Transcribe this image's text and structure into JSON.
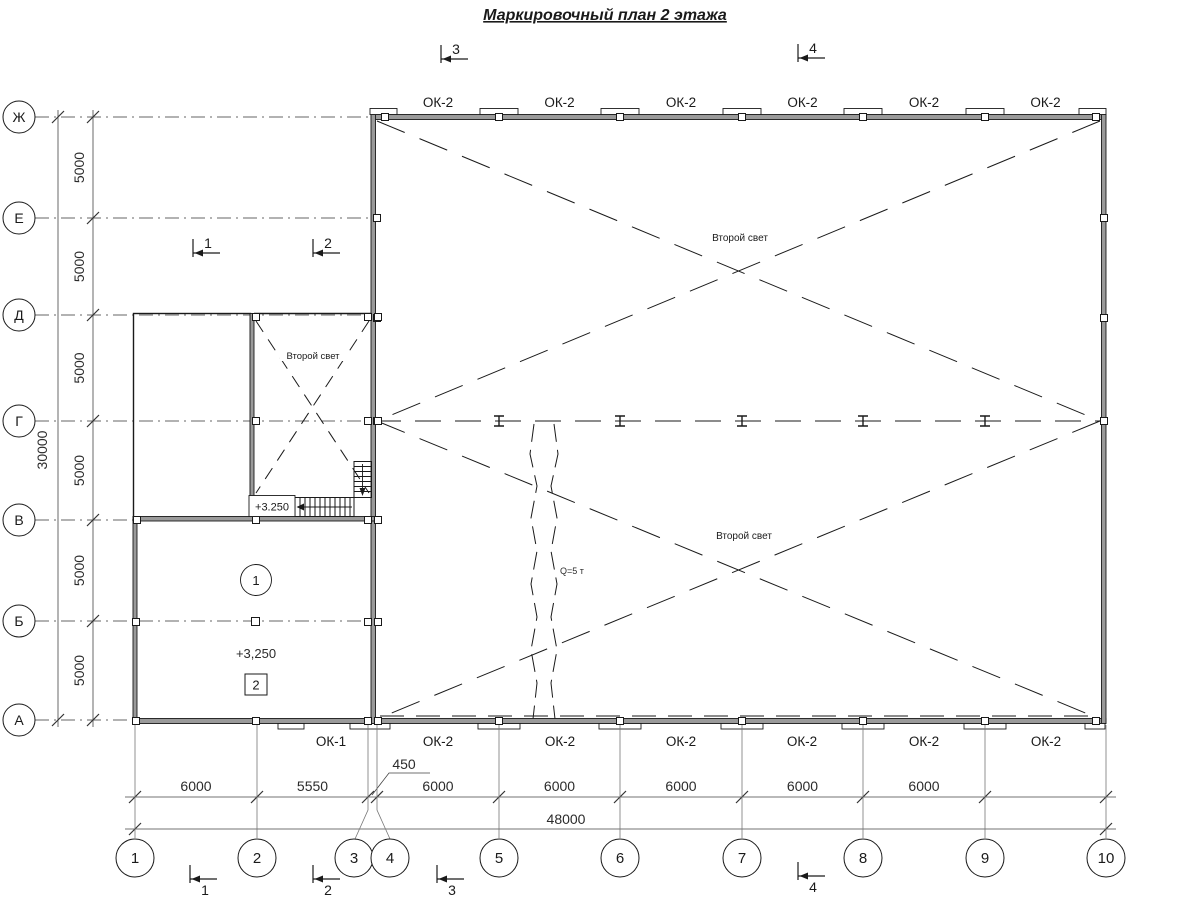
{
  "title": "Маркировочный план 2 этажа",
  "grid": {
    "row_axes": [
      "Ж",
      "Е",
      "Д",
      "Г",
      "В",
      "Б",
      "А"
    ],
    "col_axes": [
      "1",
      "2",
      "3",
      "4",
      "5",
      "6",
      "7",
      "8",
      "9",
      "10"
    ]
  },
  "dims_left": {
    "overall": "30000",
    "segments": [
      "5000",
      "5000",
      "5000",
      "5000",
      "5000",
      "5000"
    ]
  },
  "dims_bottom": {
    "overall": "48000",
    "segments": [
      "6000",
      "5550",
      "450",
      "6000",
      "6000",
      "6000",
      "6000",
      "6000"
    ]
  },
  "windows_top": [
    "ОК-2",
    "ОК-2",
    "ОК-2",
    "ОК-2",
    "ОК-2",
    "ОК-2"
  ],
  "windows_bottom": [
    "ОК-1",
    "ОК-2",
    "ОК-2",
    "ОК-2",
    "ОК-2",
    "ОК-2",
    "ОК-2"
  ],
  "labels": {
    "second_light": "Второй свет",
    "crane": "Q=5 т",
    "level_main": "+3,250",
    "level_stairs": "+3.250",
    "room_circle": "1",
    "room_box": "2"
  },
  "section_markers": {
    "top": [
      "3",
      "4"
    ],
    "middle": [
      "1",
      "2"
    ],
    "bottom": [
      "1",
      "2",
      "3",
      "4"
    ]
  }
}
